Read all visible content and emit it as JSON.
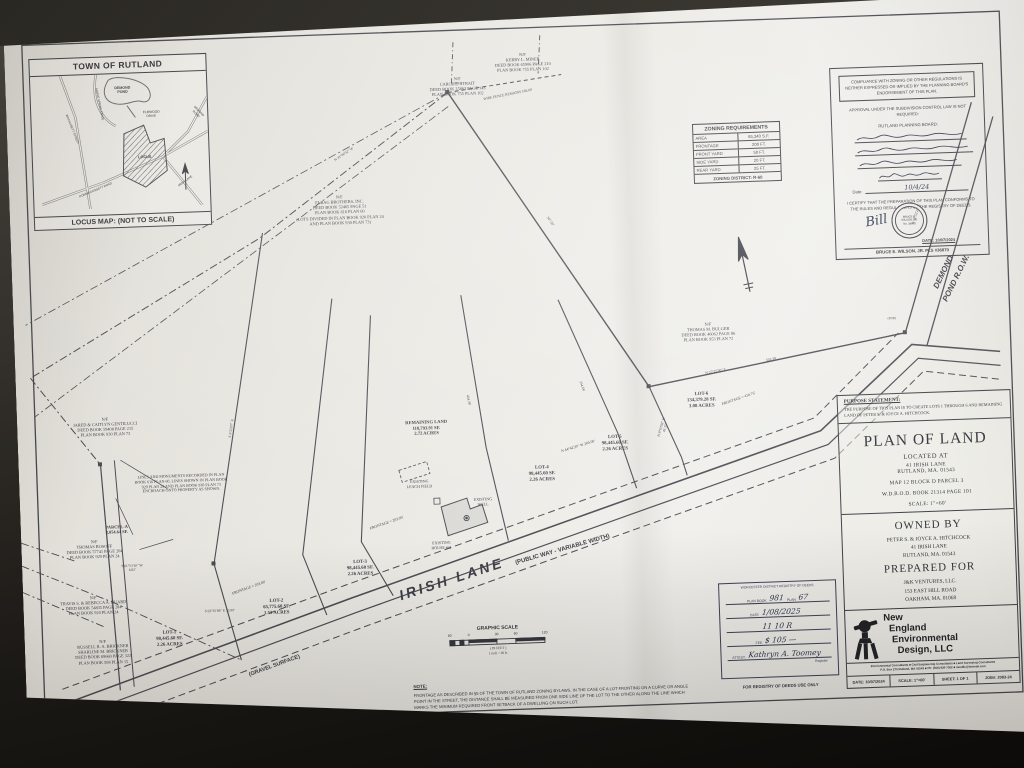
{
  "locus": {
    "title": "TOWN OF RUTLAND",
    "footer": "LOCUS MAP: (NOT TO SCALE)",
    "labels": [
      {
        "t": "DEMOND\nPOND",
        "x": 92,
        "y": 12,
        "s": 3.6,
        "b": 1
      },
      {
        "t": "ELMWOOD\nDRIVE",
        "x": 120,
        "y": 38,
        "s": 3.2
      },
      {
        "t": "LOCUS",
        "x": 112,
        "y": 82,
        "s": 3.8,
        "b": 1
      },
      {
        "t": "WACHUSETT STREET",
        "x": 40,
        "y": 52,
        "s": 3,
        "r": 70
      },
      {
        "t": "MAPLE SPRING DRIVE",
        "x": 68,
        "y": 28,
        "s": 3,
        "r": 80
      },
      {
        "t": "IRISH LANE",
        "x": 152,
        "y": 108,
        "s": 3,
        "r": -35
      },
      {
        "t": "POMMOGUSSETT ROAD",
        "x": 62,
        "y": 114,
        "s": 3,
        "r": -21
      },
      {
        "t": "DEMOND ROAD",
        "x": 166,
        "y": 38,
        "s": 3,
        "r": 48
      }
    ]
  },
  "zoning": {
    "title": "ZONING REQUIREMENTS",
    "rows": [
      {
        "k": "AREA",
        "v": "65,340 S.F."
      },
      {
        "k": "FRONTAGE",
        "v": "200 FT."
      },
      {
        "k": "FRONT YARD",
        "v": "50 FT."
      },
      {
        "k": "SIDE YARD",
        "v": "20 FT."
      },
      {
        "k": "REAR YARD",
        "v": "25 FT."
      }
    ],
    "district": "ZONING DISTRICT: R-60"
  },
  "compliance": {
    "box_text": "COMPLIANCE WITH ZONING OR OTHER REGULATIONS IS NEITHER EXPRESSED OR IMPLIED BY THE PLANNING BOARD'S ENDORSEMENT OF THIS PLAN.",
    "approval_text": "APPROVAL UNDER THE SUBDIVISION CONTROL LAW IS NOT REQUIRED:",
    "board_label": "RUTLAND PLANNING BOARD:",
    "signatures": [
      {
        "w": 112
      },
      {
        "w": 118
      },
      {
        "w": 104
      },
      {
        "w": 64
      }
    ],
    "date_label": "Date:",
    "date_value": "10/4/24",
    "certify_text": "I CERTIFY THAT THE PREPARATION OF THIS PLAN CONFORMS TO THE RULES AND REGULATIONS OF THE REGISTRY OF DEEDS.",
    "seal_text": "BRUCE E.\nWILSON, JR.\nNo. 36870",
    "surveyor_signature": "Bill",
    "stamp_date": "DATE: 10/07/2024",
    "surveyor": "BRUCE E. WILSON, JR.   PLS #36870"
  },
  "titlecol": {
    "purpose_heading": "PURPOSE STATEMENT:",
    "purpose_body": "THE PURPOSE OF THIS PLAN IS TO CREATE LOTS 1 THROUGH 6 AND REMAINING LAND OF PETER S. & JOYCE A. HITCHCOCK.",
    "title": "PLAN OF LAND",
    "located": "LOCATED AT",
    "addr": "41 IRISH LANE\nRUTLAND, MA. 01543",
    "map_ref": "MAP 12 BLOCK D PARCEL 3",
    "deed_ref": "W.D.R.O.D. BOOK 21314 PAGE 101",
    "scale_ref": "SCALE: 1\"=60'",
    "owned_heading": "OWNED BY",
    "owned_lines": "PETER S. & JOYCE A. HITCHCOCK\n41 IRISH LANE\nRUTLAND, MA. 01543",
    "prepared_heading": "PREPARED FOR",
    "prepared_lines": "J&K VENTURES, LLC.\n153 EAST HILL ROAD\nOAKHAM, MA. 01068",
    "firm_name": "New\n  England\n   Environmental\n     Design, LLC",
    "firm_tagline": "Environmental Consultants ■ Civil Engineering Consultants ■ Land Surveying Consultants\nP.O. Box 270 Rutland, MA 01543 ■ Ph: (508) 926-7302 ■ needllc@hotmail.com",
    "strip": [
      {
        "k": "DATE:",
        "v": "10/07/2024"
      },
      {
        "k": "SCALE:",
        "v": "1\"=60'"
      },
      {
        "k": "SHEET:",
        "v": "1 OF 1"
      },
      {
        "k": "JOB#:",
        "v": "2083-24"
      }
    ]
  },
  "registry": {
    "header": "WORCESTER DISTRICT REGISTRY OF DEEDS",
    "rows": [
      {
        "p": "PLAN BOOK",
        "h": "981",
        "p2": "PLAN",
        "h2": "67"
      },
      {
        "p": "DATE",
        "h": "1/08/2025"
      },
      {
        "p": "",
        "h": "11    10    R"
      },
      {
        "p": "FEE",
        "h": "$ 105 —"
      },
      {
        "p": "ATTEST:",
        "h": "Kathryn A. Toomey"
      }
    ],
    "register_label": "Register",
    "footer": "FOR REGISTRY OF DEEDS USE ONLY"
  },
  "scale": {
    "title": "GRAPHIC SCALE",
    "ticks": [
      {
        "t": "60",
        "x": 0
      },
      {
        "t": "0",
        "x": 19
      },
      {
        "t": "30",
        "x": 47
      },
      {
        "t": "60",
        "x": 66
      },
      {
        "t": "120",
        "x": 95
      }
    ],
    "sub": "( IN FEET )\n1 inch = 60 ft."
  },
  "note": {
    "heading": "NOTE:",
    "body": "FRONTAGE AS DESCRIBED IN §5 OF THE TOWN OF RUTLAND ZONING BYLAWS, IN THE CASE OF A LOT FRONTING ON A CURVE OR ANGLE POINT IN THE STREET, THE DISTANCE SHALL BE MEASURED FROM ONE SIDE LINE OF THE LOT TO THE OTHER ALONG THE LINE WHICH MARKS THE MINIMUM REQUIRED FRONT SETBACK OF A DWELLING ON SUCH LOT."
  },
  "plan_labels": [
    {
      "t": "N/F\nKERRY L. MINER\nDEED BOOK 65906 PAGE 210\nPLAN BOOK 755 PLAN 102",
      "x": 518,
      "y": 76,
      "s": 4.3
    },
    {
      "t": "N/F\nCAROL E. STRAIT\nDEED BOOK 25863 PAGE 143\nPLAN BOOK 755 PLAN 102",
      "x": 452,
      "y": 98,
      "s": 4.3
    },
    {
      "t": "N/F\nELBAG BROTHERS, INC.\nDEED BOOK 52465 PAGE 51\nPLAN BOOK 616 PLAN 60\n(LOTS DIVIDED IN PLAN BOOK 920 PLAN 24\nAND PLAN BOOK 930 PLAN 73)",
      "x": 330,
      "y": 212,
      "s": 4.3
    },
    {
      "t": "N/F\nTHOMAS M. BULGER\nDEED BOOK 46062 PAGE 86\nPLAN BOOK 953 PLAN 72",
      "x": 694,
      "y": 352,
      "s": 4.3
    },
    {
      "t": "N/F\nJARED & CAITLYN GENTILUCCI\nDEED BOOK 59408 PAGE 215\nPLAN BOOK 930 PLAN 73",
      "x": 88,
      "y": 426,
      "s": 4.3
    },
    {
      "t": "LINES AND MONUMENTS RECORDED IN PLAN\nBOOK 616 PLAN 60, LINES SHOWN IN PLAN BOOK\n920 PLAN 24 AND PLAN BOOK 930 PLAN 73\nENCROACH ONTO PROPERTY AS SHOWN.",
      "x": 162,
      "y": 486,
      "s": 4
    },
    {
      "t": "PARCEL-A\n3,054.64 SF.",
      "x": 96,
      "y": 534,
      "s": 4.4,
      "b": 1
    },
    {
      "t": "N/F\nTHOMAS ROSOFF\nDEED BOOK 57741 PAGE 204\nPLAN BOOK 920 PLAN 24",
      "x": 73,
      "y": 548,
      "s": 4.3
    },
    {
      "t": "N/F\nTRAVIS S. & REBECCA A. HUARD\nDEED BOOK 54835 PAGE 284\nPLAN BOOK 920 PLAN 24",
      "x": 70,
      "y": 604,
      "s": 4.3
    },
    {
      "t": "N/F\nRUSSELL R. A. BRICKNER\nSHARLINE M. BRICKNER\nDEED BOOK 69660 PAGE 322\nPLAN BOOK 508 PLAN 15",
      "x": 78,
      "y": 648,
      "s": 4.3
    },
    {
      "t": "LOT-1\n98,445.60 SF.\n2.26 ACRES",
      "x": 145,
      "y": 642,
      "s": 4.8,
      "b": 1
    },
    {
      "t": "LOT-2\n65,775.60 SF.\n1.51 ACRES",
      "x": 253,
      "y": 614,
      "s": 4.8,
      "b": 1
    },
    {
      "t": "LOT-3\n98,445.60 SF.\n2.26 ACRES",
      "x": 338,
      "y": 578,
      "s": 4.8,
      "b": 1
    },
    {
      "t": "LOT-4\n98,445.60 SF.\n2.26 ACRES",
      "x": 523,
      "y": 490,
      "s": 4.8,
      "b": 1
    },
    {
      "t": "LOT-5\n98,445.60 SF.\n2.26 ACRES",
      "x": 597,
      "y": 462,
      "s": 4.8,
      "b": 1
    },
    {
      "t": "LOT-6\n134,379.28 SF.\n3.08 ACRES",
      "x": 685,
      "y": 422,
      "s": 4.8,
      "b": 1
    },
    {
      "t": "REMAINING LAND\n118,793.91 SF.\n2.72 ACRES",
      "x": 409,
      "y": 440,
      "s": 4.6,
      "b": 1
    },
    {
      "t": "EXISTING\nLEACH FIELD",
      "x": 400,
      "y": 500,
      "s": 4
    },
    {
      "t": "EXISTING\nWELL",
      "x": 463,
      "y": 520,
      "s": 4
    },
    {
      "t": "EXISTING\nHOUSE #41",
      "x": 420,
      "y": 562,
      "s": 4
    },
    {
      "t": "IRISH LANE",
      "x": 429,
      "y": 592,
      "s": 14,
      "b": 1,
      "i": 1,
      "r": -16,
      "ls": 3,
      "f": "s"
    },
    {
      "t": "(PUBLIC WAY - VARIABLE WIDTH)",
      "x": 541,
      "y": 572,
      "s": 6,
      "b": 1,
      "r": -14,
      "f": "s"
    },
    {
      "t": "(GRAVEL SURFACE)",
      "x": 249,
      "y": 678,
      "s": 5.5,
      "b": 1,
      "r": -18,
      "f": "s"
    },
    {
      "t": "DEMOND\nPOND R.O.W.",
      "x": 938,
      "y": 300,
      "s": 8,
      "b": 1,
      "i": 1,
      "r": -62,
      "lh": 1.8,
      "f": "s"
    },
    {
      "t": "N 44°42'20\" W   200.00'",
      "x": 560,
      "y": 470,
      "s": 3.8,
      "r": -15
    },
    {
      "t": "FRONTAGE = 203.00'",
      "x": 366,
      "y": 540,
      "s": 3.8,
      "r": -17
    },
    {
      "t": "FRONTAGE = 203.00'",
      "x": 226,
      "y": 600,
      "s": 3.8,
      "r": -18
    },
    {
      "t": "FRONTAGE = 416.76'",
      "x": 722,
      "y": 428,
      "s": 3.8,
      "r": -17
    },
    {
      "t": "S 63°35'08\" E  35.99'",
      "x": 196,
      "y": 622,
      "s": 3.6
    },
    {
      "t": "S 61°53'10\" W\n4.82'",
      "x": 110,
      "y": 574,
      "s": 3.6
    },
    {
      "t": "WIRE FENCE REMAINS   168.00'",
      "x": 502,
      "y": 116,
      "s": 3.6,
      "r": -9
    },
    {
      "t": "347.50'",
      "x": 540,
      "y": 244,
      "s": 3.6,
      "r": 58
    },
    {
      "t": "N 31°06'52\" W",
      "x": 336,
      "y": 170,
      "s": 3.6,
      "r": -32
    },
    {
      "t": "503.39'",
      "x": 756,
      "y": 390,
      "s": 3.6,
      "r": -9
    },
    {
      "t": "N 57°25'30\" E",
      "x": 700,
      "y": 400,
      "s": 3.6,
      "r": -9
    },
    {
      "t": "N 35°52'24\" E",
      "x": 906,
      "y": 250,
      "s": 3.6,
      "r": -72
    },
    {
      "t": "N 8°03'08\" W\n43.35'",
      "x": 646,
      "y": 452,
      "s": 3.6,
      "r": -72
    },
    {
      "t": "334.64'",
      "x": 566,
      "y": 410,
      "s": 3.6,
      "r": 72
    },
    {
      "t": "434.38'",
      "x": 452,
      "y": 420,
      "s": 3.6,
      "r": 80
    },
    {
      "t": "S 5°22'07\" E",
      "x": 214,
      "y": 440,
      "s": 3.6,
      "r": -80
    },
    {
      "t": "(FND)",
      "x": 452,
      "y": 104,
      "s": 3.2
    },
    {
      "t": "(FND)",
      "x": 878,
      "y": 354,
      "s": 3.2
    }
  ]
}
